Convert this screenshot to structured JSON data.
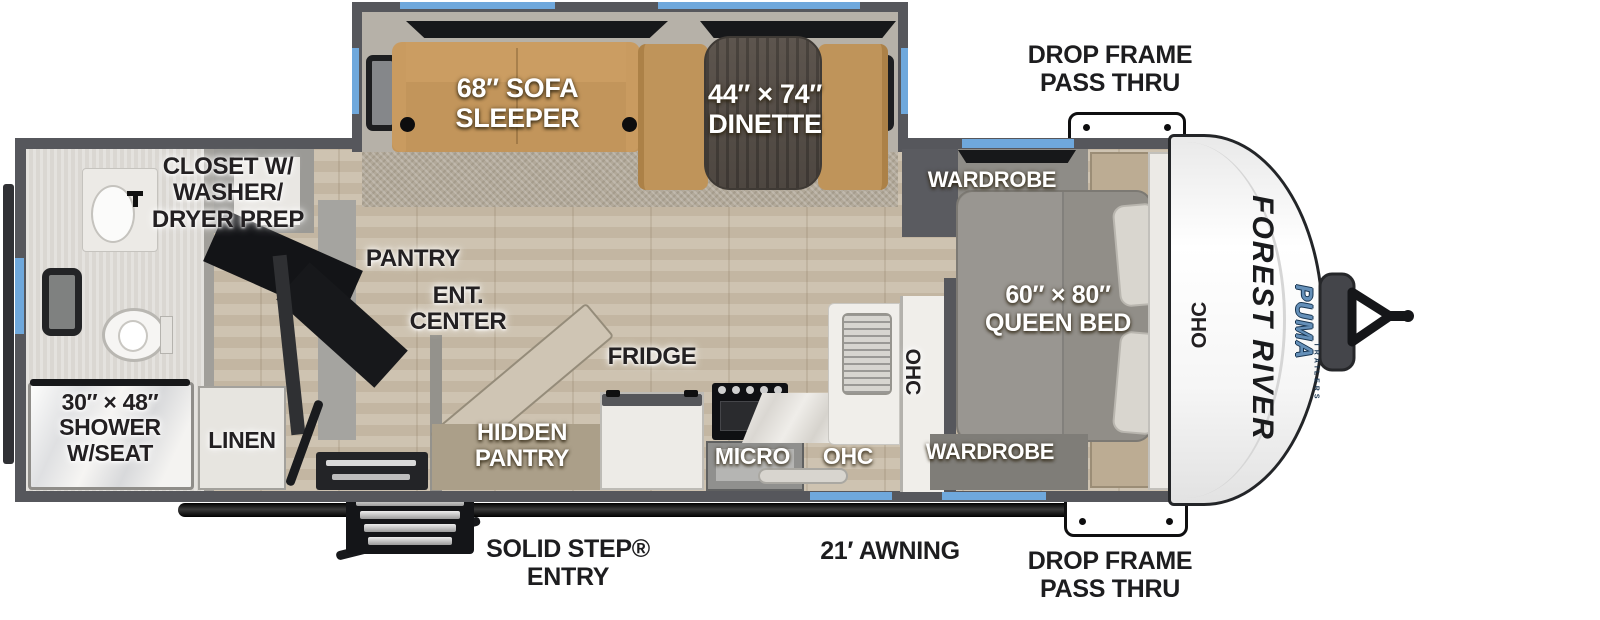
{
  "colors": {
    "window_blue": "#6FA8DC",
    "wall_gray": "#56575C",
    "sofa_tan": "#C2955B",
    "floor_tan": "#C8BCA8",
    "brand_blue": "#648FB8"
  },
  "brand": {
    "manufacturer": "FOREST RIVER",
    "model": "PUMA",
    "model_sub": "TRAILERS"
  },
  "callouts": {
    "drop_frame_top": [
      "DROP FRAME",
      "PASS THRU"
    ],
    "drop_frame_bottom": [
      "DROP FRAME",
      "PASS THRU"
    ],
    "awning": "21′ AWNING",
    "entry": [
      "SOLID STEP®",
      "ENTRY"
    ]
  },
  "rooms": {
    "sofa": [
      "68″ SOFA",
      "SLEEPER"
    ],
    "dinette": [
      "44″ × 74″",
      "DINETTE"
    ],
    "closet": [
      "CLOSET W/",
      "WASHER/",
      "DRYER PREP"
    ],
    "pantry": "PANTRY",
    "ent_center": [
      "ENT.",
      "CENTER"
    ],
    "hidden_pantry": [
      "HIDDEN",
      "PANTRY"
    ],
    "fridge": "FRIDGE",
    "micro": "MICRO",
    "ohc_kitchen": "OHC",
    "ohc_kitchen_vertical": "OHC",
    "ohc_front": "OHC",
    "wardrobe_top": "WARDROBE",
    "wardrobe_bottom": "WARDROBE",
    "queen_bed": [
      "60″ × 80″",
      "QUEEN BED"
    ],
    "shower": [
      "30″ × 48″",
      "SHOWER",
      "W/SEAT"
    ],
    "linen": "LINEN"
  }
}
